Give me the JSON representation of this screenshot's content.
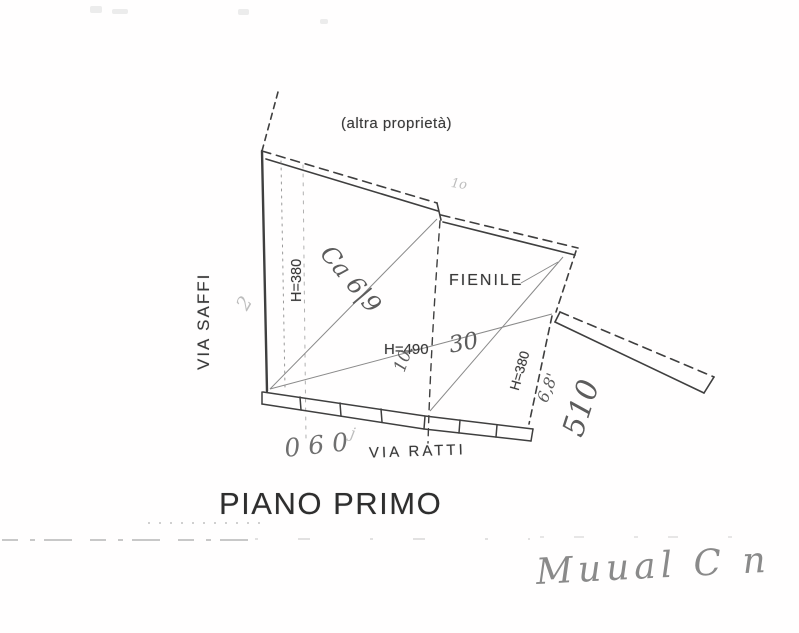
{
  "document": {
    "title": "PIANO PRIMO",
    "labels": {
      "other_property": "(altra proprietà)",
      "street_left": "VIA SAFFI",
      "street_bottom": "VIA RATTI",
      "room": "FIENILE",
      "height_left_room": "H=380",
      "height_main_room": "H=490",
      "height_right_room": "H=380"
    },
    "handwriting": {
      "left_digit": "2",
      "center_note": "Ca 6|9",
      "ten_note": "10.",
      "faint_note": "1o",
      "thirty_note": "30",
      "six_eight_note": "6,8'",
      "five_ten_note": "510",
      "bottom_note": "060",
      "bottom_note_extra": "j",
      "signature": "Muual C n"
    },
    "colors": {
      "ink": "#3f3f3f",
      "pencil": "#6f6f6f",
      "faint": "#bdbdbd",
      "paper": "#ffffff"
    }
  }
}
